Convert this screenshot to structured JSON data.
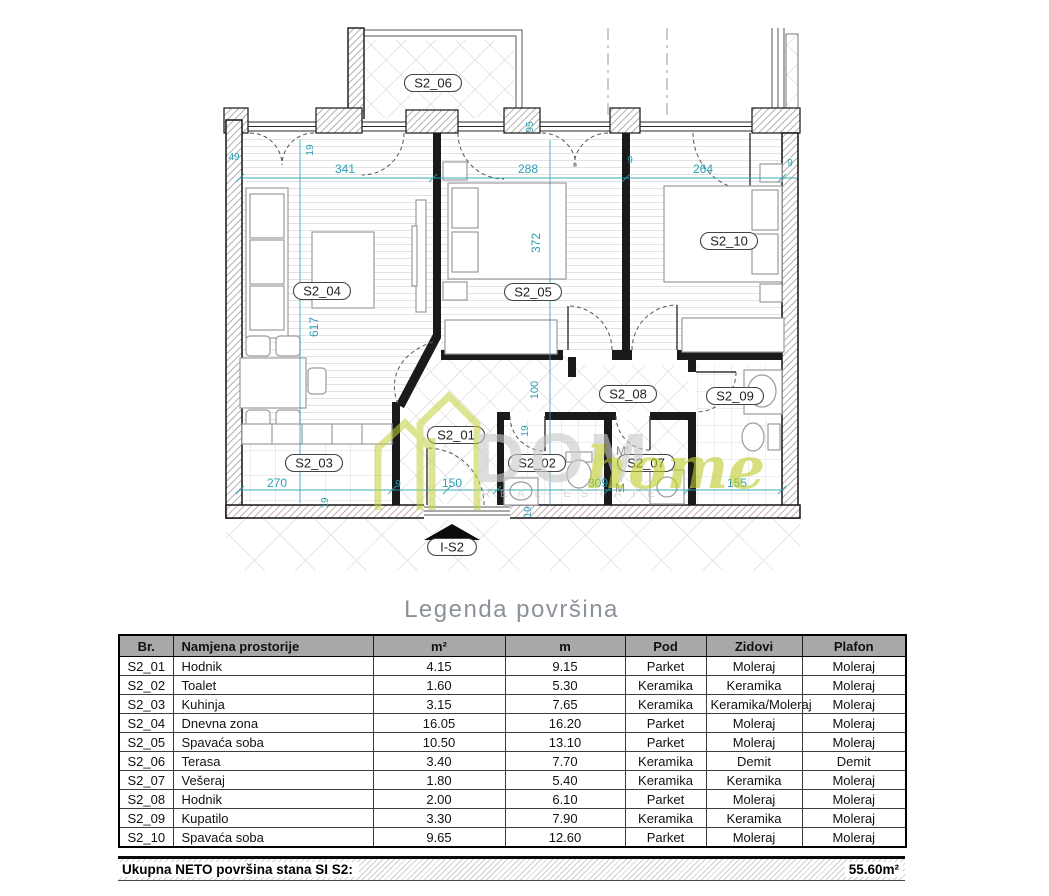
{
  "plan": {
    "room_labels": [
      {
        "id": "S2_06",
        "x": 433,
        "y": 83
      },
      {
        "id": "S2_04",
        "x": 322,
        "y": 291
      },
      {
        "id": "S2_05",
        "x": 533,
        "y": 292
      },
      {
        "id": "S2_10",
        "x": 729,
        "y": 241
      },
      {
        "id": "S2_03",
        "x": 314,
        "y": 463
      },
      {
        "id": "S2_01",
        "x": 456,
        "y": 435
      },
      {
        "id": "S2_02",
        "x": 537,
        "y": 463
      },
      {
        "id": "S2_07",
        "x": 646,
        "y": 463
      },
      {
        "id": "S2_08",
        "x": 628,
        "y": 394
      },
      {
        "id": "S2_09",
        "x": 735,
        "y": 396
      },
      {
        "id": "I-S2",
        "x": 452,
        "y": 547
      }
    ],
    "dimensions": [
      {
        "t": "341",
        "x": 345,
        "y": 173,
        "r": 0,
        "s": 12
      },
      {
        "t": "288",
        "x": 528,
        "y": 173,
        "r": 0,
        "s": 12
      },
      {
        "t": "264",
        "x": 703,
        "y": 173,
        "r": 0,
        "s": 12
      },
      {
        "t": "49",
        "x": 234,
        "y": 160,
        "r": 0,
        "s": 10
      },
      {
        "t": "9",
        "x": 630,
        "y": 163,
        "r": 0,
        "s": 10
      },
      {
        "t": "9",
        "x": 790,
        "y": 166,
        "r": 0,
        "s": 10
      },
      {
        "t": "19",
        "x": 313,
        "y": 150,
        "r": -90,
        "s": 10
      },
      {
        "t": "95",
        "x": 533,
        "y": 127,
        "r": -90,
        "s": 10
      },
      {
        "t": "372",
        "x": 540,
        "y": 243,
        "r": -90,
        "s": 12
      },
      {
        "t": "617",
        "x": 318,
        "y": 327,
        "r": -90,
        "s": 12
      },
      {
        "t": "100",
        "x": 538,
        "y": 390,
        "r": -90,
        "s": 11
      },
      {
        "t": "19",
        "x": 528,
        "y": 431,
        "r": -90,
        "s": 10
      },
      {
        "t": "270",
        "x": 277,
        "y": 487,
        "r": 0,
        "s": 12
      },
      {
        "t": "9",
        "x": 398,
        "y": 487,
        "r": 0,
        "s": 10
      },
      {
        "t": "150",
        "x": 452,
        "y": 487,
        "r": 0,
        "s": 12
      },
      {
        "t": "309",
        "x": 598,
        "y": 487,
        "r": 0,
        "s": 12
      },
      {
        "t": "155",
        "x": 737,
        "y": 487,
        "r": 0,
        "s": 12
      },
      {
        "t": "19",
        "x": 328,
        "y": 503,
        "r": -90,
        "s": 10
      },
      {
        "t": "19",
        "x": 531,
        "y": 512,
        "r": -90,
        "s": 10
      }
    ],
    "annotations": [
      {
        "t": "M'",
        "x": 616,
        "y": 455
      },
      {
        "t": "M",
        "x": 615,
        "y": 492
      }
    ],
    "watermark": {
      "brand_gray": "DOM",
      "brand_green": "home",
      "tagline": "REAL ESTATE"
    },
    "colors": {
      "dimension": "#2a9fb4",
      "watermark_green": "#c5d13c",
      "watermark_gray": "#cfcfcf",
      "wall": "#141414"
    }
  },
  "legend": {
    "title": "Legenda površina",
    "columns": [
      "Br.",
      "Namjena prostorije",
      "m²",
      "m",
      "Pod",
      "Zidovi",
      "Plafon"
    ],
    "rows": [
      {
        "br": "S2_01",
        "namjena": "Hodnik",
        "m2": "4.15",
        "m": "9.15",
        "pod": "Parket",
        "zidovi": "Moleraj",
        "plafon": "Moleraj"
      },
      {
        "br": "S2_02",
        "namjena": "Toalet",
        "m2": "1.60",
        "m": "5.30",
        "pod": "Keramika",
        "zidovi": "Keramika",
        "plafon": "Moleraj"
      },
      {
        "br": "S2_03",
        "namjena": "Kuhinja",
        "m2": "3.15",
        "m": "7.65",
        "pod": "Keramika",
        "zidovi": "Keramika/Moleraj",
        "plafon": "Moleraj"
      },
      {
        "br": "S2_04",
        "namjena": "Dnevna zona",
        "m2": "16.05",
        "m": "16.20",
        "pod": "Parket",
        "zidovi": "Moleraj",
        "plafon": "Moleraj"
      },
      {
        "br": "S2_05",
        "namjena": "Spavaća soba",
        "m2": "10.50",
        "m": "13.10",
        "pod": "Parket",
        "zidovi": "Moleraj",
        "plafon": "Moleraj"
      },
      {
        "br": "S2_06",
        "namjena": "Terasa",
        "m2": "3.40",
        "m": "7.70",
        "pod": "Keramika",
        "zidovi": "Demit",
        "plafon": "Demit"
      },
      {
        "br": "S2_07",
        "namjena": "Vešeraj",
        "m2": "1.80",
        "m": "5.40",
        "pod": "Keramika",
        "zidovi": "Keramika",
        "plafon": "Moleraj"
      },
      {
        "br": "S2_08",
        "namjena": "Hodnik",
        "m2": "2.00",
        "m": "6.10",
        "pod": "Parket",
        "zidovi": "Moleraj",
        "plafon": "Moleraj"
      },
      {
        "br": "S2_09",
        "namjena": "Kupatilo",
        "m2": "3.30",
        "m": "7.90",
        "pod": "Keramika",
        "zidovi": "Keramika",
        "plafon": "Moleraj"
      },
      {
        "br": "S2_10",
        "namjena": "Spavaća soba",
        "m2": "9.65",
        "m": "12.60",
        "pod": "Parket",
        "zidovi": "Moleraj",
        "plafon": "Moleraj"
      }
    ],
    "footer": {
      "label": "Ukupna NETO površina stana SI  S2:",
      "value": "55.60m²"
    }
  }
}
